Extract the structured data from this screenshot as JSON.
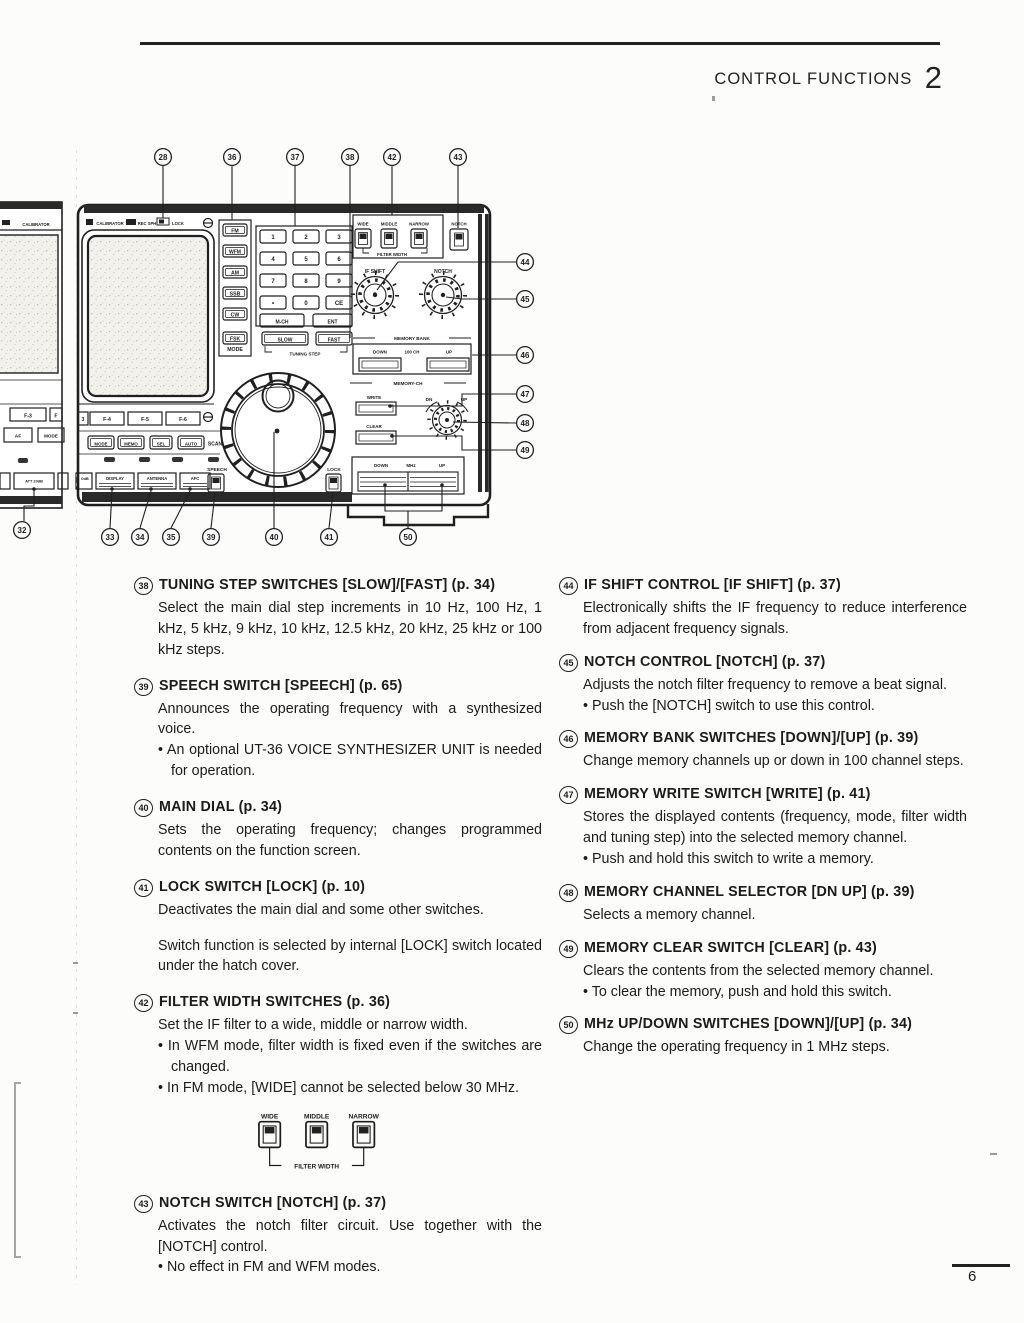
{
  "page": {
    "header_title": "CONTROL FUNCTIONS",
    "header_number": "2",
    "page_number": "6"
  },
  "diagram": {
    "callouts": {
      "n28": "28",
      "n32": "32",
      "n33": "33",
      "n34": "34",
      "n35": "35",
      "n36": "36",
      "n37": "37",
      "n38": "38",
      "n39": "39",
      "n40": "40",
      "n41": "41",
      "n42": "42",
      "n43": "43",
      "n44": "44",
      "n45": "45",
      "n46": "46",
      "n47": "47",
      "n48": "48",
      "n49": "49",
      "n50": "50"
    },
    "strip": {
      "calibrator": "CALIBRATOR",
      "f3": "F-3",
      "fpart": "F",
      "af": "AF",
      "mode": "MODE",
      "att": "ATT 20dB"
    },
    "top": {
      "calibrator": "CALIBRATOR",
      "rec": "REC SPH",
      "lock": "LOCK"
    },
    "mode": {
      "label": "MODE",
      "b": [
        "FM",
        "WFM",
        "AM",
        "SSB",
        "CW",
        "FSK"
      ]
    },
    "keypad": [
      "1",
      "2",
      "3",
      "4",
      "5",
      "6",
      "7",
      "8",
      "9",
      "•",
      "0",
      "CE"
    ],
    "kp": {
      "mch": "M-CH",
      "ent": "ENT"
    },
    "tune": {
      "slow": "SLOW",
      "fast": "FAST",
      "label": "TUNING STEP"
    },
    "filter": {
      "wide": "WIDE",
      "middle": "MIDDLE",
      "narrow": "NARROW",
      "label": "FILTER WIDTH",
      "notch": "NOTCH"
    },
    "knob": {
      "ifshift": "IF SHIFT",
      "notch": "NOTCH"
    },
    "bank": {
      "label": "MEMORY BANK",
      "down": "DOWN",
      "ch": "100 CH",
      "up": "UP"
    },
    "mch": {
      "label": "MEMORY-CH",
      "write": "WRITE",
      "clear": "CLEAR",
      "dn": "DN",
      "up": "UP"
    },
    "mhz": {
      "down": "DOWN",
      "label": "MHz",
      "up": "UP"
    },
    "fkeys": [
      "3",
      "F-4",
      "F-5",
      "F-6"
    ],
    "scan": {
      "label": "SCAN",
      "b": [
        "MODE",
        "MEMO",
        "SEL",
        "AUTO"
      ]
    },
    "bottom": {
      "att": "0dB",
      "b": [
        "DISPLAY",
        "ANTENNA",
        "AFC"
      ],
      "speech": "SPEECH",
      "lock": "LOCK"
    }
  },
  "figure": {
    "wide": "WIDE",
    "middle": "MIDDLE",
    "narrow": "NARROW",
    "caption": "FILTER WIDTH"
  },
  "sections": {
    "left": [
      {
        "num": "38",
        "title": "TUNING STEP SWITCHES [SLOW]/[FAST] (p. 34)",
        "body": [
          "Select the main dial step increments in 10 Hz, 100 Hz, 1 kHz, 5 kHz, 9 kHz, 10 kHz, 12.5 kHz, 20 kHz, 25 kHz or 100 kHz steps."
        ]
      },
      {
        "num": "39",
        "title": "SPEECH SWITCH [SPEECH] (p. 65)",
        "body": [
          "Announces the operating frequency with a synthesized voice."
        ],
        "bullets": [
          "An optional UT-36 VOICE SYNTHESIZER UNIT is needed for operation."
        ]
      },
      {
        "num": "40",
        "title": "MAIN DIAL (p. 34)",
        "body": [
          "Sets the operating frequency; changes programmed contents on the function screen."
        ]
      },
      {
        "num": "41",
        "title": "LOCK SWITCH [LOCK] (p. 10)",
        "body": [
          "Deactivates the main dial and some other switches.",
          "Switch function is selected by internal [LOCK] switch located under the hatch cover."
        ]
      },
      {
        "num": "42",
        "title": "FILTER WIDTH SWITCHES (p. 36)",
        "body": [
          "Set the IF filter to a wide, middle or narrow width."
        ],
        "bullets": [
          "In WFM mode, filter width is fixed even if the switches are changed.",
          "In FM mode, [WIDE] cannot be selected below 30 MHz."
        ]
      },
      {
        "num": "43",
        "title": "NOTCH SWITCH [NOTCH] (p. 37)",
        "body": [
          "Activates the notch filter circuit.  Use together with the [NOTCH] control."
        ],
        "bullets": [
          "No effect in FM and WFM modes."
        ]
      }
    ],
    "right": [
      {
        "num": "44",
        "title": "IF SHIFT CONTROL [IF SHIFT] (p. 37)",
        "body": [
          "Electronically shifts the IF frequency to reduce interference from adjacent frequency signals."
        ]
      },
      {
        "num": "45",
        "title": "NOTCH CONTROL [NOTCH] (p. 37)",
        "body": [
          "Adjusts the notch filter frequency to remove a beat signal."
        ],
        "bullets": [
          "Push the [NOTCH] switch to use this control."
        ]
      },
      {
        "num": "46",
        "title": "MEMORY BANK SWITCHES [DOWN]/[UP] (p. 39)",
        "body": [
          "Change memory channels up or down in 100 channel steps."
        ]
      },
      {
        "num": "47",
        "title": "MEMORY WRITE SWITCH [WRITE] (p. 41)",
        "body": [
          "Stores the displayed contents (frequency, mode, filter width and tuning step) into the selected memory channel."
        ],
        "bullets": [
          "Push and hold this switch to write a memory."
        ]
      },
      {
        "num": "48",
        "title": "MEMORY CHANNEL SELECTOR [DN UP] (p. 39)",
        "body": [
          "Selects a memory channel."
        ]
      },
      {
        "num": "49",
        "title": "MEMORY CLEAR SWITCH [CLEAR] (p. 43)",
        "body": [
          "Clears the contents from the selected memory channel."
        ],
        "bullets": [
          "To clear the memory, push and hold this switch."
        ]
      },
      {
        "num": "50",
        "title": "MHz UP/DOWN SWITCHES [DOWN]/[UP] (p. 34)",
        "body": [
          "Change the operating frequency in 1 MHz steps."
        ]
      }
    ]
  }
}
